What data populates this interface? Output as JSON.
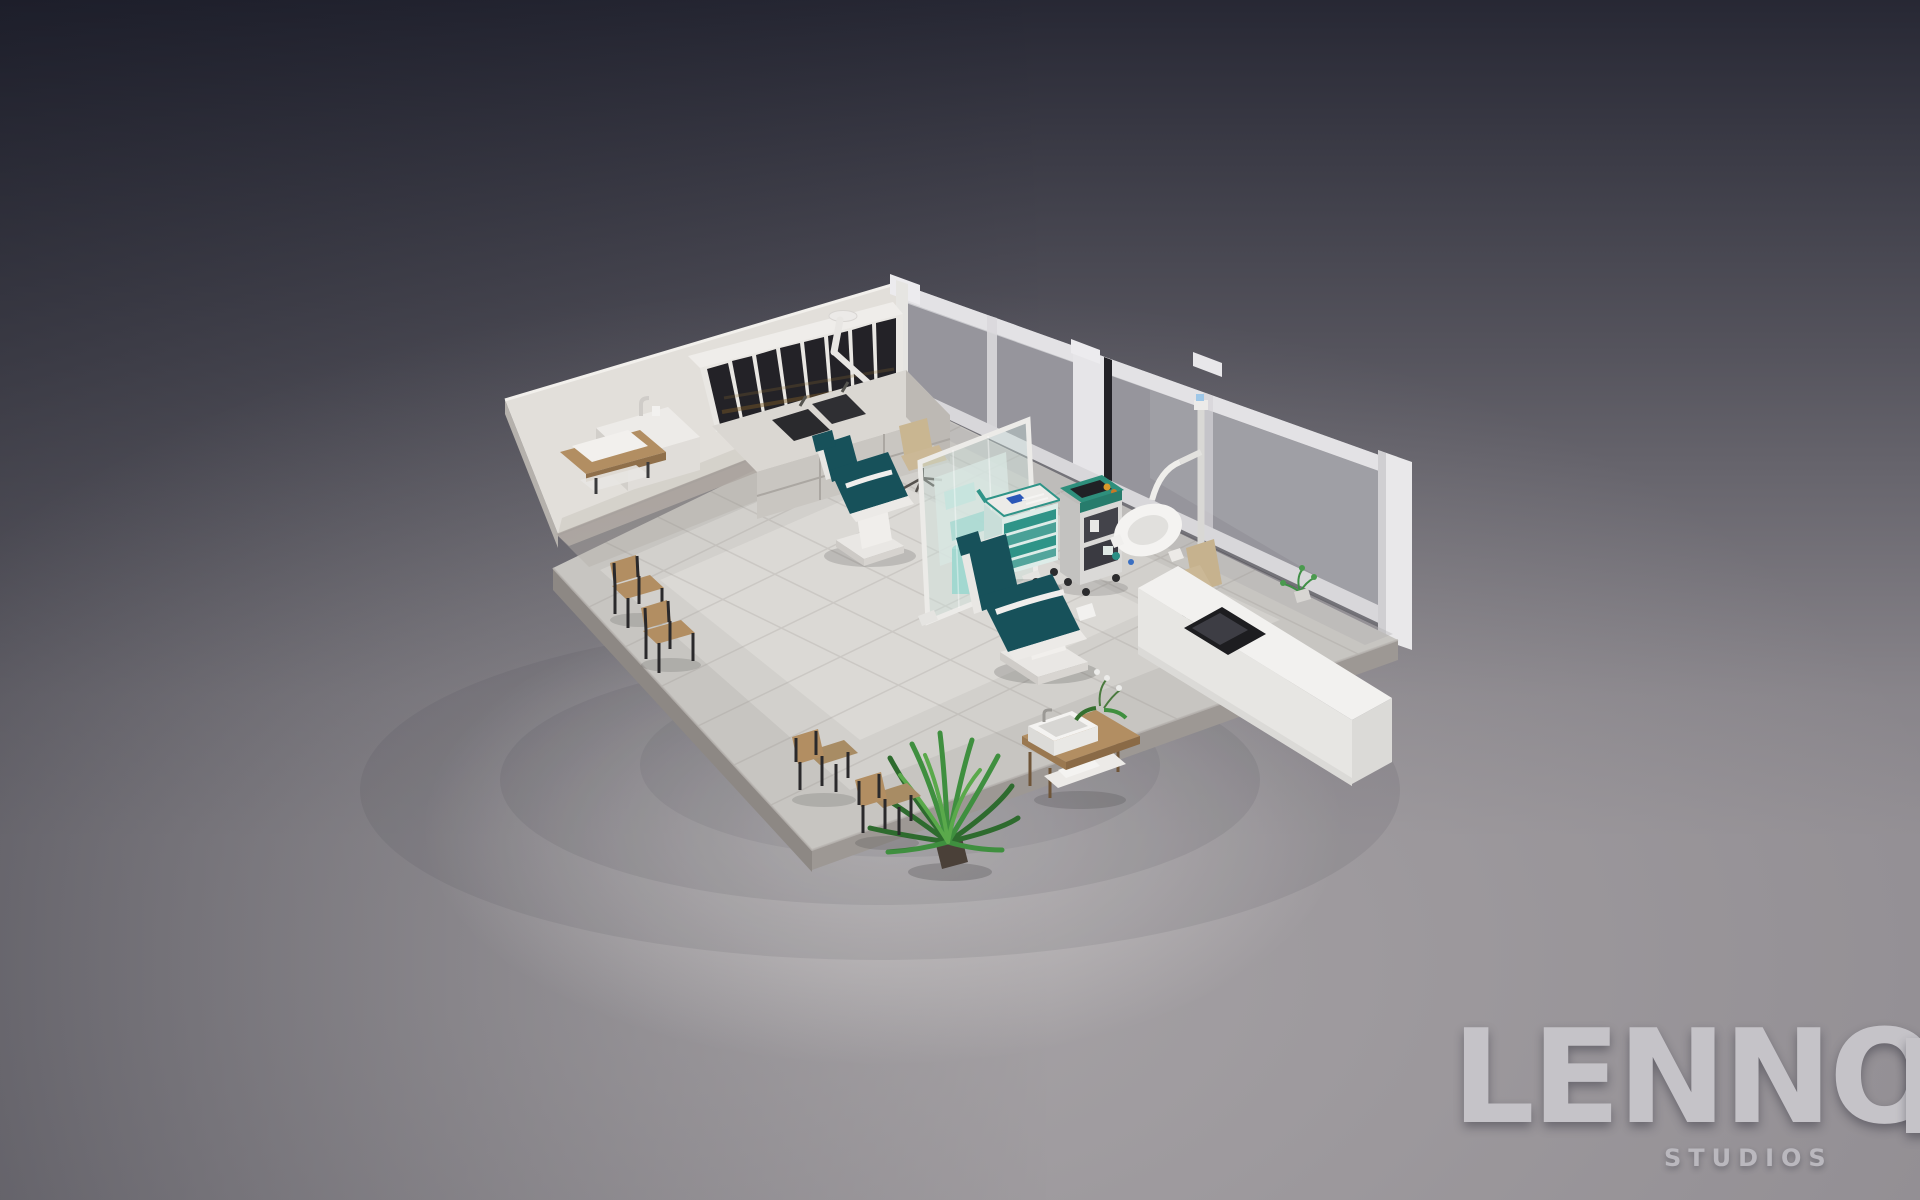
{
  "image": {
    "kind": "isometric 3d render",
    "subject": "dental clinic interior cutaway with treatment chairs, reception desk and waiting area",
    "objects": [
      "left white wall",
      "frosted glass rear wall with door post",
      "tiled floor platform",
      "wall cabinet with dark glass doors",
      "ceiling-arm tool light",
      "storage counter with twin sinks",
      "handwash sink unit",
      "wall shelf with towels",
      "dentist office chair",
      "dental treatment chair 1",
      "glass divider screen",
      "supply shelf and water tank",
      "mobile dental cart",
      "medical equipment cabinet",
      "dental operating lamp",
      "dental treatment chair 2",
      "desk office chair",
      "reception desk with dark workstation inset",
      "desk plant",
      "wooden side table with wash basin and orchid",
      "potted fern",
      "wooden waiting chairs"
    ]
  },
  "brand": {
    "wordmark": "LENNO",
    "tagline": "STUDIOS"
  },
  "colors": {
    "background_top": "#262938",
    "background_bottom": "#938f94",
    "light_pool": "#e8e5e3",
    "wall": "#e2dfda",
    "glass_wall": "#96959c",
    "floor": "#c7c5c1",
    "platform_side": "#8d8884",
    "upholstery_teal": "#17515a",
    "cart_teal": "#2f9488",
    "equipment_green": "#2e8f7c",
    "wood": "#b28e62",
    "chair_beige": "#cbb896",
    "plant_green": "#3f8f3f",
    "logo_text": "#c5c3c8"
  }
}
